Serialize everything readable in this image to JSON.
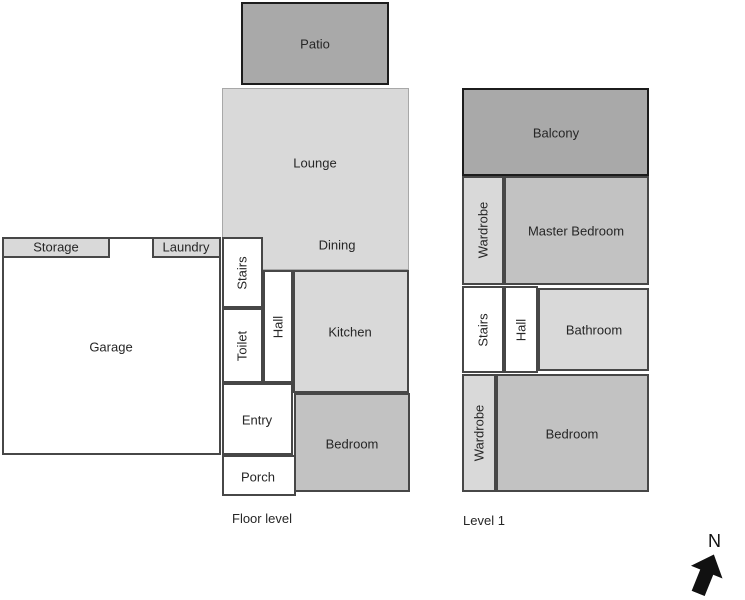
{
  "colors": {
    "room_light": "#d9d9d9",
    "room_medium": "#c2c2c2",
    "room_dark": "#a9a9a9",
    "room_white": "#ffffff",
    "border_dark": "#474747",
    "border_black": "#1c1c1c",
    "border_light": "#a8a8a8",
    "text": "#262626"
  },
  "plans": [
    {
      "name": "floor-level",
      "caption": "Floor level",
      "rooms": [
        {
          "name": "lounge-dining",
          "fill": "light",
          "border": "light",
          "x": 222,
          "y": 88,
          "w": 187,
          "h": 182,
          "labels": [
            {
              "text": "Lounge",
              "x": 315,
              "y": 163
            },
            {
              "text": "Dining",
              "x": 337,
              "y": 245
            }
          ]
        },
        {
          "name": "patio",
          "fill": "dark",
          "border": "black",
          "x": 241,
          "y": 2,
          "w": 148,
          "h": 83,
          "labels": [
            {
              "text": "Patio",
              "x": 315,
              "y": 44
            }
          ]
        },
        {
          "name": "garage",
          "fill": "white",
          "border": "dark",
          "x": 2,
          "y": 237,
          "w": 219,
          "h": 218,
          "labels": [
            {
              "text": "Garage",
              "x": 111,
              "y": 347
            }
          ]
        },
        {
          "name": "storage",
          "fill": "light",
          "border": "dark",
          "x": 2,
          "y": 237,
          "w": 108,
          "h": 21,
          "labels": [
            {
              "text": "Storage",
              "x": 56,
              "y": 247
            }
          ]
        },
        {
          "name": "laundry",
          "fill": "light",
          "border": "dark",
          "x": 152,
          "y": 237,
          "w": 69,
          "h": 21,
          "labels": [
            {
              "text": "Laundry",
              "x": 186,
              "y": 247
            }
          ]
        },
        {
          "name": "stairs-floor",
          "fill": "white",
          "border": "dark",
          "x": 222,
          "y": 237,
          "w": 41,
          "h": 71,
          "labels": [
            {
              "text": "Stairs",
              "x": 242,
              "y": 273,
              "rot": -90
            }
          ]
        },
        {
          "name": "toilet",
          "fill": "white",
          "border": "dark",
          "x": 222,
          "y": 308,
          "w": 41,
          "h": 75,
          "labels": [
            {
              "text": "Toilet",
              "x": 242,
              "y": 346,
              "rot": -90
            }
          ]
        },
        {
          "name": "hall-floor",
          "fill": "white",
          "border": "dark",
          "x": 263,
          "y": 270,
          "w": 30,
          "h": 113,
          "labels": [
            {
              "text": "Hall",
              "x": 278,
              "y": 327,
              "rot": -90
            }
          ]
        },
        {
          "name": "kitchen",
          "fill": "light",
          "border": "dark",
          "x": 293,
          "y": 270,
          "w": 116,
          "h": 123,
          "labels": [
            {
              "text": "Kitchen",
              "x": 350,
              "y": 332
            }
          ]
        },
        {
          "name": "bedroom-floor",
          "fill": "medium",
          "border": "dark",
          "x": 294,
          "y": 393,
          "w": 116,
          "h": 99,
          "labels": [
            {
              "text": "Bedroom",
              "x": 352,
              "y": 444
            }
          ]
        },
        {
          "name": "entry",
          "fill": "white",
          "border": "dark",
          "x": 222,
          "y": 383,
          "w": 71,
          "h": 72,
          "labels": [
            {
              "text": "Entry",
              "x": 257,
              "y": 420
            }
          ]
        },
        {
          "name": "porch",
          "fill": "white",
          "border": "dark",
          "x": 222,
          "y": 455,
          "w": 74,
          "h": 41,
          "labels": [
            {
              "text": "Porch",
              "x": 258,
              "y": 477
            }
          ]
        }
      ]
    },
    {
      "name": "level-1",
      "caption": "Level 1",
      "rooms": [
        {
          "name": "balcony",
          "fill": "dark",
          "border": "black",
          "x": 462,
          "y": 88,
          "w": 187,
          "h": 88,
          "labels": [
            {
              "text": "Balcony",
              "x": 556,
              "y": 133
            }
          ]
        },
        {
          "name": "wardrobe-upper",
          "fill": "light",
          "border": "dark",
          "x": 462,
          "y": 176,
          "w": 42,
          "h": 109,
          "labels": [
            {
              "text": "Wardrobe",
              "x": 483,
              "y": 230,
              "rot": -90
            }
          ]
        },
        {
          "name": "master-bedroom",
          "fill": "medium",
          "border": "dark",
          "x": 504,
          "y": 176,
          "w": 145,
          "h": 109,
          "labels": [
            {
              "text": "Master Bedroom",
              "x": 576,
              "y": 231
            }
          ]
        },
        {
          "name": "stairs-level1",
          "fill": "white",
          "border": "dark",
          "x": 462,
          "y": 286,
          "w": 42,
          "h": 87,
          "labels": [
            {
              "text": "Stairs",
              "x": 483,
              "y": 330,
              "rot": -90
            }
          ]
        },
        {
          "name": "hall-level1",
          "fill": "white",
          "border": "dark",
          "x": 504,
          "y": 286,
          "w": 34,
          "h": 87,
          "labels": [
            {
              "text": "Hall",
              "x": 521,
              "y": 330,
              "rot": -90
            }
          ]
        },
        {
          "name": "bathroom",
          "fill": "light",
          "border": "dark",
          "x": 538,
          "y": 288,
          "w": 111,
          "h": 83,
          "labels": [
            {
              "text": "Bathroom",
              "x": 594,
              "y": 330
            }
          ]
        },
        {
          "name": "wardrobe-lower",
          "fill": "light",
          "border": "dark",
          "x": 462,
          "y": 374,
          "w": 34,
          "h": 118,
          "labels": [
            {
              "text": "Wardrobe",
              "x": 479,
              "y": 433,
              "rot": -90
            }
          ]
        },
        {
          "name": "bedroom-level1",
          "fill": "medium",
          "border": "dark",
          "x": 496,
          "y": 374,
          "w": 153,
          "h": 118,
          "labels": [
            {
              "text": "Bedroom",
              "x": 572,
              "y": 434
            }
          ]
        }
      ]
    }
  ],
  "compass": {
    "label": "N"
  }
}
